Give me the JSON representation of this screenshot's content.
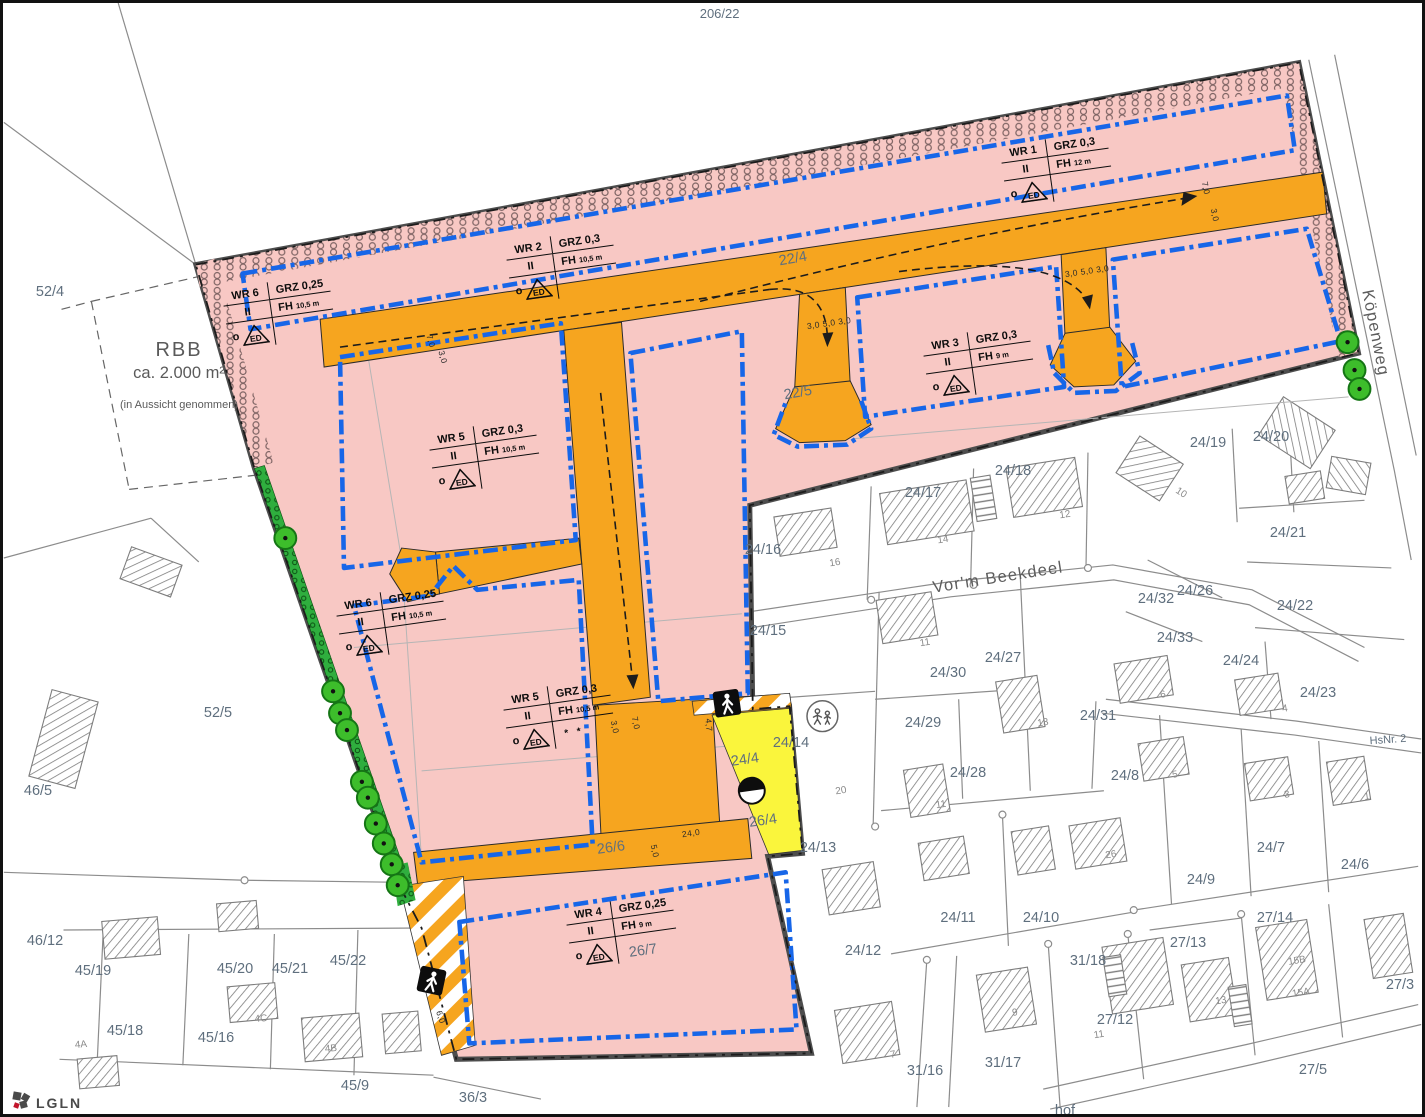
{
  "title_label": "206/22",
  "logo": {
    "text": "LGLN"
  },
  "rbb": {
    "name": "RBB",
    "area": "ca. 2.000 m²",
    "note": "(in Aussicht genommen)"
  },
  "streets": {
    "koepenweg": "Köpenweg",
    "beekdeel": "Vor'm Beekdeel"
  },
  "wr_tables": [
    {
      "name": "WR 6",
      "grz": "GRZ 0,25",
      "floors": "II",
      "fh": "FH",
      "fh_value": "10,5 m",
      "open": "o",
      "ed": "ED",
      "note": ""
    },
    {
      "name": "WR 2",
      "grz": "GRZ 0,3",
      "floors": "II",
      "fh": "FH",
      "fh_value": "10,5 m",
      "open": "o",
      "ed": "ED",
      "note": ""
    },
    {
      "name": "WR 1",
      "grz": "GRZ 0,3",
      "floors": "II",
      "fh": "FH",
      "fh_value": "12 m",
      "open": "o",
      "ed": "ED",
      "note": ""
    },
    {
      "name": "WR 3",
      "grz": "GRZ 0,3",
      "floors": "II",
      "fh": "FH",
      "fh_value": "9 m",
      "open": "o",
      "ed": "ED",
      "note": ""
    },
    {
      "name": "WR 5",
      "grz": "GRZ 0,3",
      "floors": "II",
      "fh": "FH",
      "fh_value": "10,5 m",
      "open": "o",
      "ed": "ED",
      "note": ""
    },
    {
      "name": "WR 6",
      "grz": "GRZ 0,25",
      "floors": "II",
      "fh": "FH",
      "fh_value": "10,5 m",
      "open": "o",
      "ed": "ED",
      "note": ""
    },
    {
      "name": "WR 5",
      "grz": "GRZ 0,3",
      "floors": "II",
      "fh": "FH",
      "fh_value": "10,5 m",
      "open": "o",
      "ed": "ED",
      "note": "* *"
    },
    {
      "name": "WR 4",
      "grz": "GRZ 0,25",
      "floors": "II",
      "fh": "FH",
      "fh_value": "9 m",
      "open": "o",
      "ed": "ED",
      "note": ""
    }
  ],
  "colors": {
    "site_pink": "#F8C8C4",
    "road_orange": "#F6A51F",
    "envelope_blue": "#1766E8",
    "path_yellow": "#FAF53C",
    "tree_green": "#3DBD2B",
    "boundary_gray": "#4D4D4D",
    "cadastral_gray": "#8C8C8C",
    "label_gray_blue": "#5F6F7E"
  },
  "map_labels": [
    {
      "text": "52/4",
      "x": 47,
      "y": 289
    },
    {
      "text": "52/5",
      "x": 215,
      "y": 710
    },
    {
      "text": "46/5",
      "x": 35,
      "y": 788
    },
    {
      "text": "46/12",
      "x": 42,
      "y": 938
    },
    {
      "text": "45/19",
      "x": 90,
      "y": 968
    },
    {
      "text": "45/20",
      "x": 232,
      "y": 966
    },
    {
      "text": "45/21",
      "x": 287,
      "y": 966
    },
    {
      "text": "45/22",
      "x": 345,
      "y": 958
    },
    {
      "text": "45/18",
      "x": 122,
      "y": 1028
    },
    {
      "text": "45/16",
      "x": 213,
      "y": 1035
    },
    {
      "text": "45/9",
      "x": 352,
      "y": 1083
    },
    {
      "text": "36/3",
      "x": 470,
      "y": 1095
    },
    {
      "text": "22/4",
      "x": 790,
      "y": 256,
      "r": -10
    },
    {
      "text": "22/5",
      "x": 795,
      "y": 390,
      "r": -10
    },
    {
      "text": "26/6",
      "x": 608,
      "y": 845,
      "r": -8
    },
    {
      "text": "26/7",
      "x": 640,
      "y": 948,
      "r": -8
    },
    {
      "text": "24/4",
      "x": 742,
      "y": 757,
      "r": -8
    },
    {
      "text": "26/4",
      "x": 760,
      "y": 818,
      "r": -8
    },
    {
      "text": "24/13",
      "x": 815,
      "y": 845
    },
    {
      "text": "24/14",
      "x": 788,
      "y": 740
    },
    {
      "text": "24/15",
      "x": 765,
      "y": 628
    },
    {
      "text": "24/16",
      "x": 760,
      "y": 547
    },
    {
      "text": "24/17",
      "x": 920,
      "y": 490
    },
    {
      "text": "24/18",
      "x": 1010,
      "y": 468
    },
    {
      "text": "24/19",
      "x": 1205,
      "y": 440
    },
    {
      "text": "24/20",
      "x": 1268,
      "y": 434
    },
    {
      "text": "24/21",
      "x": 1285,
      "y": 530
    },
    {
      "text": "24/22",
      "x": 1292,
      "y": 603
    },
    {
      "text": "24/23",
      "x": 1315,
      "y": 690
    },
    {
      "text": "24/24",
      "x": 1238,
      "y": 658
    },
    {
      "text": "24/26",
      "x": 1192,
      "y": 588
    },
    {
      "text": "24/32",
      "x": 1153,
      "y": 596
    },
    {
      "text": "24/33",
      "x": 1172,
      "y": 635
    },
    {
      "text": "24/30",
      "x": 945,
      "y": 670
    },
    {
      "text": "24/27",
      "x": 1000,
      "y": 655
    },
    {
      "text": "24/29",
      "x": 920,
      "y": 720
    },
    {
      "text": "24/28",
      "x": 965,
      "y": 770
    },
    {
      "text": "24/31",
      "x": 1095,
      "y": 713
    },
    {
      "text": "24/8",
      "x": 1122,
      "y": 773
    },
    {
      "text": "24/9",
      "x": 1198,
      "y": 877
    },
    {
      "text": "24/7",
      "x": 1268,
      "y": 845
    },
    {
      "text": "24/6",
      "x": 1352,
      "y": 862
    },
    {
      "text": "24/11",
      "x": 955,
      "y": 915
    },
    {
      "text": "24/10",
      "x": 1038,
      "y": 915
    },
    {
      "text": "24/12",
      "x": 860,
      "y": 948
    },
    {
      "text": "27/14",
      "x": 1272,
      "y": 915
    },
    {
      "text": "27/13",
      "x": 1185,
      "y": 940
    },
    {
      "text": "31/18",
      "x": 1085,
      "y": 958
    },
    {
      "text": "27/12",
      "x": 1112,
      "y": 1017
    },
    {
      "text": "27/3",
      "x": 1397,
      "y": 982
    },
    {
      "text": "31/16",
      "x": 922,
      "y": 1068
    },
    {
      "text": "31/17",
      "x": 1000,
      "y": 1060
    },
    {
      "text": "27/5",
      "x": 1310,
      "y": 1067
    },
    {
      "text": "hof",
      "x": 1062,
      "y": 1108
    },
    {
      "text": "HsNr. 2",
      "x": 1385,
      "y": 737,
      "r": -4,
      "cls": "pls"
    },
    {
      "text": "24,0",
      "x": 688,
      "y": 830,
      "r": -8,
      "cls": "dim"
    },
    {
      "text": "6,0",
      "x": 438,
      "y": 1014,
      "r": 70,
      "cls": "dim"
    },
    {
      "text": "4,7",
      "x": 706,
      "y": 722,
      "r": 85,
      "cls": "dim"
    },
    {
      "text": "3,0",
      "x": 612,
      "y": 724,
      "r": 78,
      "cls": "dim"
    },
    {
      "text": "7,0",
      "x": 633,
      "y": 720,
      "r": 78,
      "cls": "dim"
    },
    {
      "text": "3,0  5,0  3,0",
      "x": 826,
      "y": 320,
      "r": -8,
      "cls": "dim"
    },
    {
      "text": "3,0  5,0  3,0",
      "x": 1084,
      "y": 268,
      "r": -8,
      "cls": "dim"
    },
    {
      "text": "5,0",
      "x": 652,
      "y": 848,
      "r": 78,
      "cls": "dim"
    },
    {
      "text": "7,0",
      "x": 428,
      "y": 338,
      "r": 75,
      "cls": "dim"
    },
    {
      "text": "3,0",
      "x": 440,
      "y": 354,
      "r": 75,
      "cls": "dim"
    },
    {
      "text": "7,0",
      "x": 1203,
      "y": 185,
      "r": 78,
      "cls": "dim"
    },
    {
      "text": "3,0",
      "x": 1212,
      "y": 212,
      "r": 78,
      "cls": "dim"
    },
    {
      "text": "16",
      "x": 832,
      "y": 560,
      "r": -9,
      "cls": "hn"
    },
    {
      "text": "14",
      "x": 940,
      "y": 537,
      "r": -9,
      "cls": "hn"
    },
    {
      "text": "12",
      "x": 1062,
      "y": 512,
      "r": -9,
      "cls": "hn"
    },
    {
      "text": "10",
      "x": 1178,
      "y": 490,
      "r": 33,
      "cls": "hn"
    },
    {
      "text": "11",
      "x": 922,
      "y": 640,
      "r": -9,
      "cls": "hn"
    },
    {
      "text": "13",
      "x": 1040,
      "y": 720,
      "r": -9,
      "cls": "hn"
    },
    {
      "text": "11",
      "x": 938,
      "y": 802,
      "r": -9,
      "cls": "hn"
    },
    {
      "text": "6",
      "x": 1160,
      "y": 692,
      "r": -9,
      "cls": "hn"
    },
    {
      "text": "4",
      "x": 1282,
      "y": 706,
      "r": -9,
      "cls": "hn"
    },
    {
      "text": "5",
      "x": 1172,
      "y": 772,
      "r": -9,
      "cls": "hn"
    },
    {
      "text": "3",
      "x": 1284,
      "y": 792,
      "r": -9,
      "cls": "hn"
    },
    {
      "text": "1",
      "x": 1364,
      "y": 794,
      "r": -9,
      "cls": "hn"
    },
    {
      "text": "26",
      "x": 1108,
      "y": 852,
      "r": -9,
      "cls": "hn"
    },
    {
      "text": "20",
      "x": 838,
      "y": 788,
      "r": -9,
      "cls": "hn"
    },
    {
      "text": "7",
      "x": 890,
      "y": 1052,
      "r": -9,
      "cls": "hn"
    },
    {
      "text": "9",
      "x": 1012,
      "y": 1010,
      "r": -9,
      "cls": "hn"
    },
    {
      "text": "11",
      "x": 1096,
      "y": 1032,
      "r": -9,
      "cls": "hn"
    },
    {
      "text": "13",
      "x": 1218,
      "y": 998,
      "r": -9,
      "cls": "hn"
    },
    {
      "text": "15B",
      "x": 1294,
      "y": 958,
      "r": -9,
      "cls": "hn"
    },
    {
      "text": "15A",
      "x": 1298,
      "y": 990,
      "r": -9,
      "cls": "hn"
    },
    {
      "text": "4C",
      "x": 258,
      "y": 1016,
      "r": -5,
      "cls": "hn"
    },
    {
      "text": "4B",
      "x": 328,
      "y": 1046,
      "r": -5,
      "cls": "hn"
    },
    {
      "text": "4A",
      "x": 78,
      "y": 1042,
      "r": -5,
      "cls": "hn"
    }
  ]
}
